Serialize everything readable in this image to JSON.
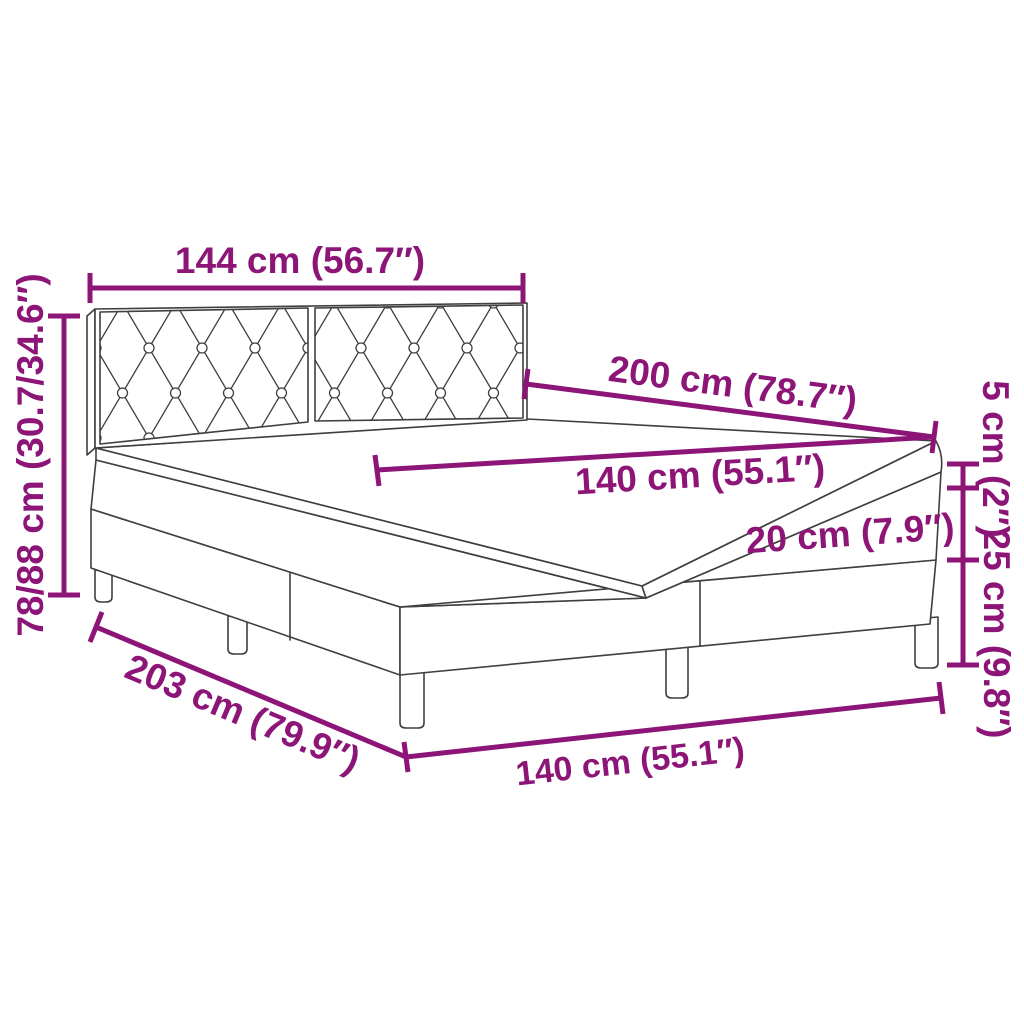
{
  "page": {
    "background": "#FFFFFF",
    "kind": "product dimension diagram"
  },
  "colors": {
    "accent": "#8C1577",
    "line": "#3F3F3F",
    "surface": "#FFFFFF"
  },
  "product": {
    "name": "Box spring bed with tufted headboard, mattress and topper"
  },
  "labels": {
    "headboard_width": "144 cm (56.7″)",
    "total_height": "78/88 cm (30.7/34.6″)",
    "bed_length": "200 cm (78.7″)",
    "mattress_width": "140 cm (55.1″)",
    "mattress_thickness": "20 cm (7.9″)",
    "topper_thickness": "5 cm (2″)",
    "base_height": "25 cm (9.8″)",
    "base_length": "203 cm (79.9″)",
    "base_width": "140 cm (55.1″)"
  }
}
